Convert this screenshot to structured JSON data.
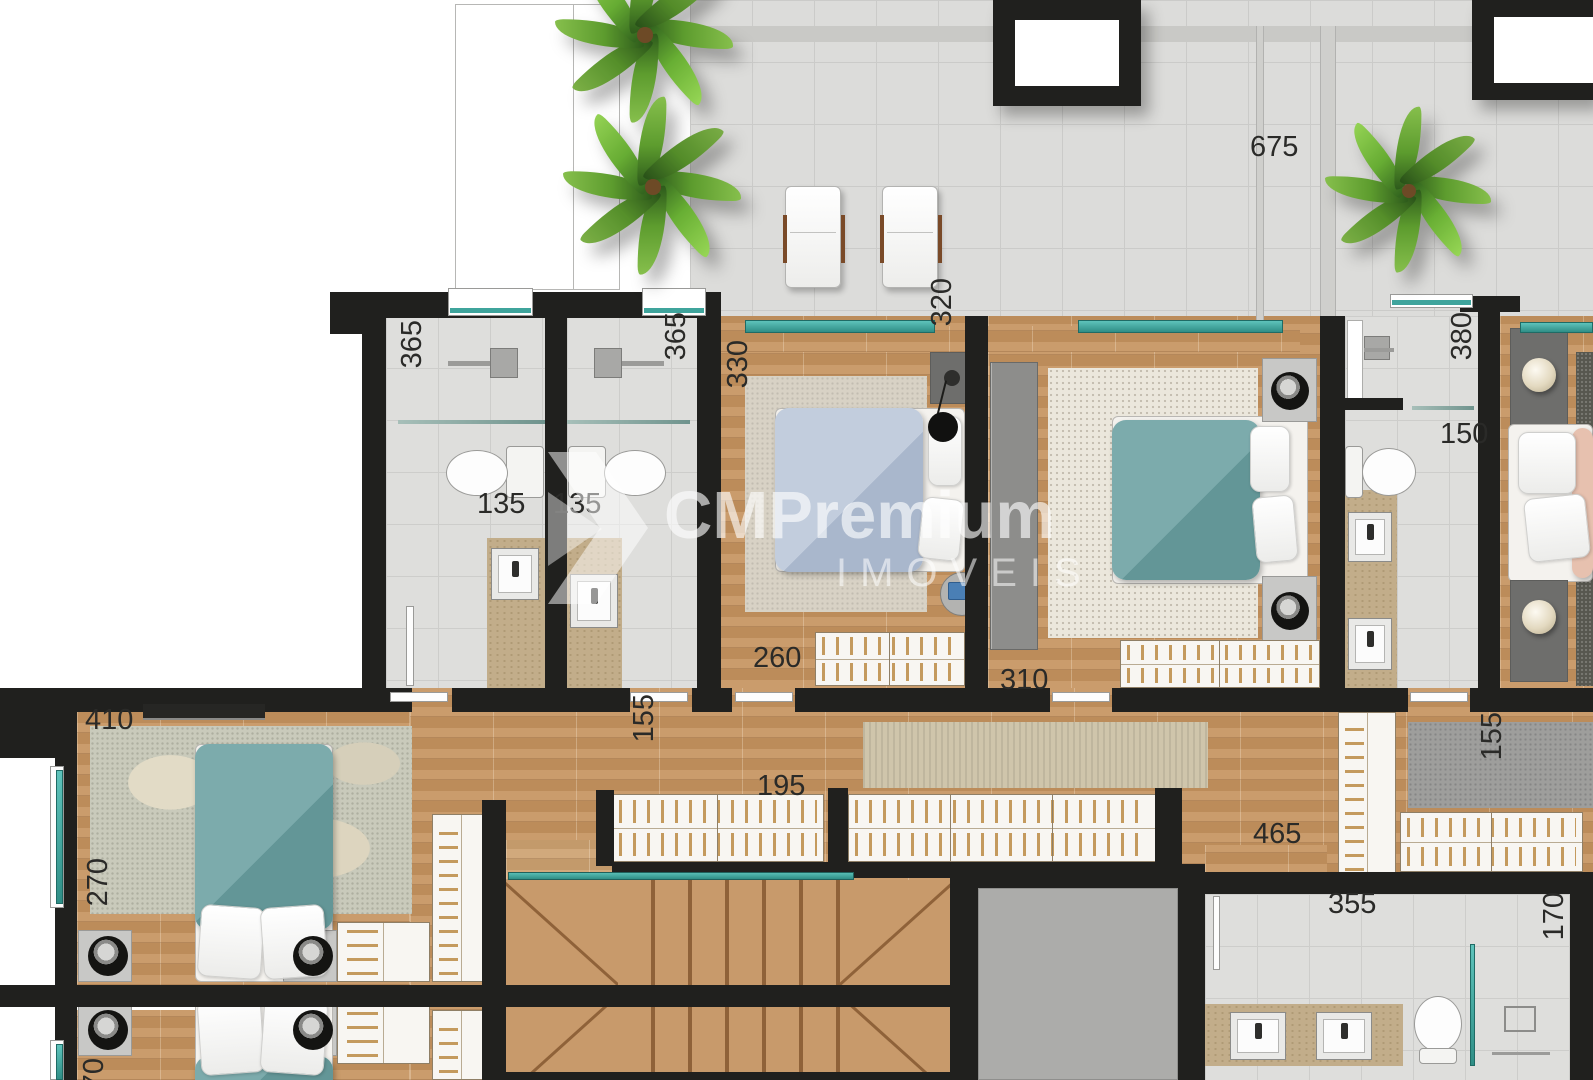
{
  "meta": {
    "width": 1593,
    "height": 1080,
    "type": "residential-floor-plan"
  },
  "watermark": {
    "brand": "CMPremium",
    "sub": "IMOVEIS"
  },
  "dimension_labels": [
    {
      "id": "terrace-width",
      "text": "675",
      "x": 1250,
      "y": 133,
      "rot": 0
    },
    {
      "id": "terrace-depth",
      "text": "320",
      "x": 928,
      "y": 278,
      "rot": 90
    },
    {
      "id": "bath1-depth",
      "text": "365",
      "x": 398,
      "y": 320,
      "rot": 90
    },
    {
      "id": "bath2-depth",
      "text": "365",
      "x": 662,
      "y": 312,
      "rot": 90
    },
    {
      "id": "bedroom1-depth",
      "text": "330",
      "x": 724,
      "y": 340,
      "rot": 90
    },
    {
      "id": "bath3-depth",
      "text": "380",
      "x": 1448,
      "y": 312,
      "rot": 90
    },
    {
      "id": "bath3-width",
      "text": "150",
      "x": 1440,
      "y": 420,
      "rot": 0
    },
    {
      "id": "bath1-width",
      "text": "135",
      "x": 477,
      "y": 490,
      "rot": 0
    },
    {
      "id": "bath2-width",
      "text": "135",
      "x": 553,
      "y": 490,
      "rot": 0
    },
    {
      "id": "bedroom1-width",
      "text": "260",
      "x": 753,
      "y": 644,
      "rot": 0
    },
    {
      "id": "bedroom2-width",
      "text": "310",
      "x": 1000,
      "y": 666,
      "rot": 0
    },
    {
      "id": "bedroom3-width",
      "text": "410",
      "x": 85,
      "y": 706,
      "rot": 0
    },
    {
      "id": "hall-width",
      "text": "155",
      "x": 630,
      "y": 694,
      "rot": 90
    },
    {
      "id": "hall-length",
      "text": "195",
      "x": 757,
      "y": 772,
      "rot": 0
    },
    {
      "id": "hall-right-length",
      "text": "465",
      "x": 1253,
      "y": 820,
      "rot": 0
    },
    {
      "id": "hall-right-width",
      "text": "155",
      "x": 1478,
      "y": 712,
      "rot": 90
    },
    {
      "id": "bedroom3-depth",
      "text": "270",
      "x": 84,
      "y": 858,
      "rot": 90
    },
    {
      "id": "bath4-width",
      "text": "355",
      "x": 1328,
      "y": 890,
      "rot": 0
    },
    {
      "id": "bath4-depth",
      "text": "170",
      "x": 1540,
      "y": 892,
      "rot": 90
    },
    {
      "id": "bedroom4-depth",
      "text": "270",
      "x": 80,
      "y": 1058,
      "rot": 90
    }
  ],
  "palette": {
    "wall": "#20201e",
    "wood_floor": "#c6945f",
    "terrace_tile": "#dcdcda",
    "bathroom_tile": "#dededc",
    "glass_teal": "#3fa49c",
    "counter_beige": "#c2ad8a",
    "bed_teal": "#6ba0a1",
    "bed_blue": "#b4c0d4",
    "elevator_void": "#acacaa",
    "palm_green": "#5d9c2e",
    "label_text": "#2a2a28",
    "watermark_white": "#ffffff"
  }
}
